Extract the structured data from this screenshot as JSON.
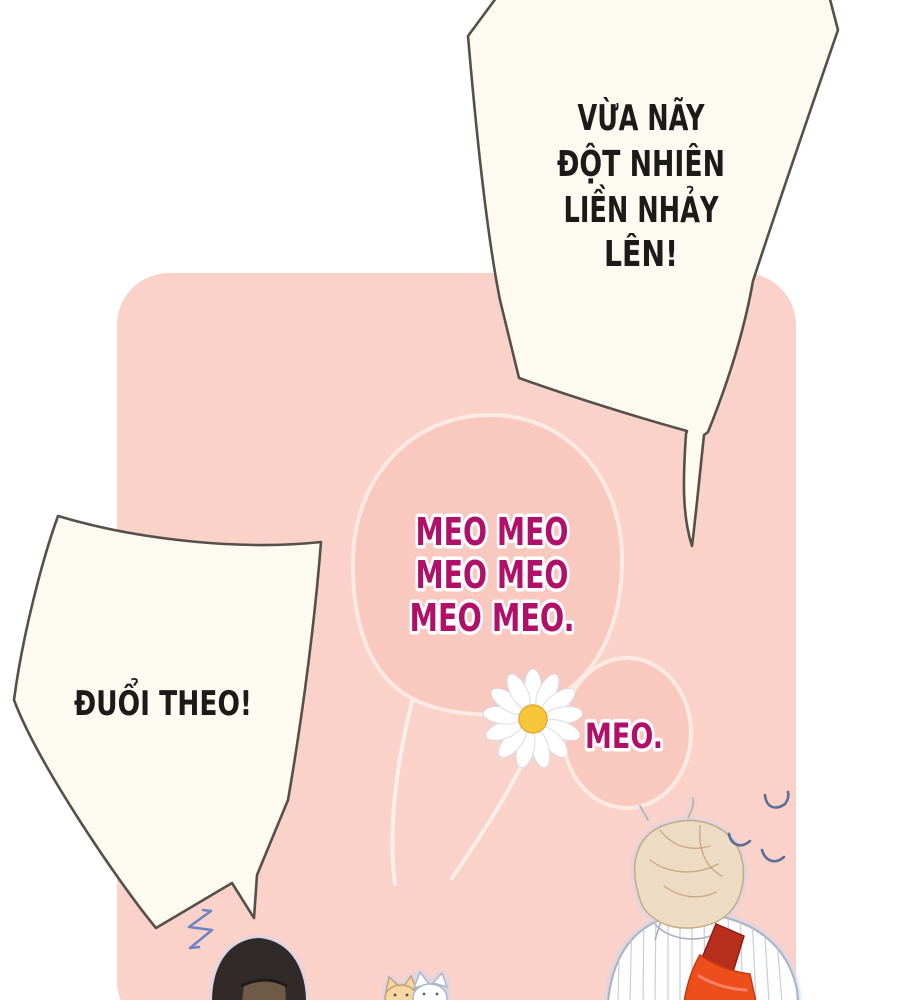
{
  "bubbles": {
    "top_right": {
      "lines": [
        "VỪA NÃY",
        "ĐỘT NHIÊN",
        "LIỀN NHẢY",
        "LÊN!"
      ],
      "fill": "#fdfaf2",
      "outline": "#56504a",
      "text_color": "#1d1b1a"
    },
    "chase": {
      "line": "ĐUỔI THEO!",
      "fill": "#fdfaf2",
      "outline": "#56504a",
      "text_color": "#1d1b1a"
    },
    "meow_large": {
      "lines": [
        "MEO MEO",
        "MEO MEO",
        "MEO MEO."
      ],
      "fill": "#f9c8bf",
      "outline": "#fdeae3",
      "text_color": "#b11069"
    },
    "meow_small": {
      "line": "MEO.",
      "fill": "#f9c8bf",
      "outline": "#fdeae3",
      "text_color": "#b11069"
    }
  },
  "panel": {
    "fill": "#fbd2ca"
  },
  "colors": {
    "page_background": "#ffffff",
    "panel_pink": "#fbd2ca",
    "blob_pink": "#f9c8bf",
    "blob_stroke": "#fdeae3",
    "bubble_cream": "#fdfaf2",
    "bubble_outline": "#56504a",
    "meow_magenta": "#b11069",
    "speech_black": "#1d1b1a",
    "daisy_center_yellow": "#f6c63b",
    "startle_blue": "#6f84c2",
    "bird_blue": "#5c6e96",
    "cap_black": "#302b28",
    "cap_brown": "#6f5947",
    "hair_sand": "#eddcc3",
    "shirt_white": "#fefefe",
    "strap_dark_red": "#b92f1d",
    "bag_orange": "#ee4d1c",
    "glow_periwinkle": "#d9e1f6"
  },
  "figures": {
    "flower": "daisy-flower",
    "startle": "startle-mark",
    "birds": [
      "bird-mark",
      "bird-mark",
      "bird-mark"
    ],
    "cats": [
      "cat-orange",
      "cat-white"
    ],
    "characters": [
      "person-black-cap",
      "person-back-striped-shirt"
    ]
  }
}
